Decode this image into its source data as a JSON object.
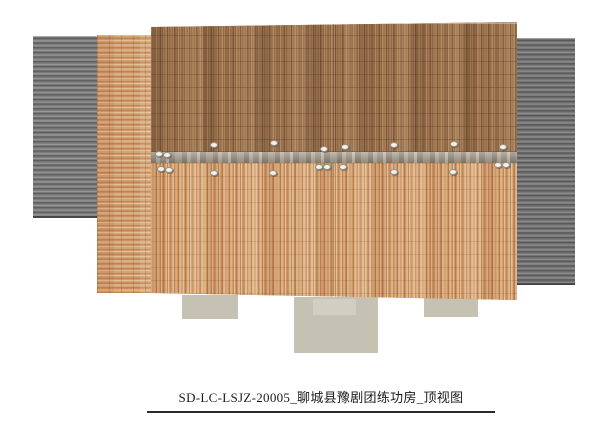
{
  "sheet": {
    "caption": "SD-LC-LSJZ-20005_聊城县豫剧团练功房_顶视图"
  },
  "palette": {
    "sheet_bg": "#ffffff",
    "corrugated_base": "#7f7f7f",
    "corrugated_dark": "#565656",
    "corrugated_light": "#a0a0a0",
    "tile_upper_base": "#9d7851",
    "tile_lower_base": "#cfa377",
    "tile_strip_base": "#d0a274",
    "ridge_base": "#a09786",
    "slab": "#c5c2b3",
    "slab_light": "#d1cfc1",
    "dot": "#f2f0ea",
    "caption_text": "#1b1b1b"
  },
  "regions": [
    {
      "name": "left-corrugated-roof",
      "type": "corrugated",
      "x": 33,
      "y": 36,
      "w": 64,
      "h": 182
    },
    {
      "name": "right-corrugated-roof",
      "type": "corrugated corrugated-right",
      "x": 513,
      "y": 38,
      "w": 62,
      "h": 247
    },
    {
      "name": "left-tile-roof-strip",
      "type": "tile-courses",
      "x": 97,
      "y": 35,
      "w": 54,
      "h": 258
    },
    {
      "name": "slab-left",
      "type": "slab",
      "x": 182,
      "y": 295,
      "w": 56,
      "h": 24
    },
    {
      "name": "slab-center",
      "type": "slab",
      "x": 294,
      "y": 297,
      "w": 84,
      "h": 56
    },
    {
      "name": "slab-center-inner",
      "type": "slab-light",
      "x": 313,
      "y": 299,
      "w": 43,
      "h": 16
    },
    {
      "name": "slab-right",
      "type": "slab",
      "x": 424,
      "y": 297,
      "w": 54,
      "h": 20
    },
    {
      "name": "main-roof-upper-slope",
      "type": "tile-v-dark",
      "x": 151,
      "y": 22,
      "w": 366,
      "h": 130,
      "clip": "polygon(0 5px, 100% 0, 100% 100%, 0 100%)"
    },
    {
      "name": "roof-ridge-flashing",
      "type": "ridge",
      "x": 151,
      "y": 152,
      "w": 366,
      "h": 11
    },
    {
      "name": "main-roof-lower-slope",
      "type": "tile-v-light",
      "x": 151,
      "y": 163,
      "w": 366,
      "h": 137,
      "clip": "polygon(0 0, 100% 0, 100% 137px, 0 130px)"
    }
  ],
  "seams": [
    {
      "x": 333,
      "y1": 24,
      "y2": 152
    },
    {
      "x": 333,
      "y1": 163,
      "y2": 296
    }
  ],
  "ridge_dots": [
    [
      213,
      144
    ],
    [
      273,
      142
    ],
    [
      323,
      148
    ],
    [
      344,
      146
    ],
    [
      393,
      144
    ],
    [
      453,
      143
    ],
    [
      502,
      146
    ],
    [
      158,
      153
    ],
    [
      166,
      154
    ],
    [
      160,
      168
    ],
    [
      168,
      169
    ],
    [
      213,
      172
    ],
    [
      272,
      172
    ],
    [
      318,
      166
    ],
    [
      326,
      166
    ],
    [
      342,
      166
    ],
    [
      393,
      171
    ],
    [
      452,
      171
    ],
    [
      497,
      164
    ],
    [
      505,
      164
    ]
  ]
}
